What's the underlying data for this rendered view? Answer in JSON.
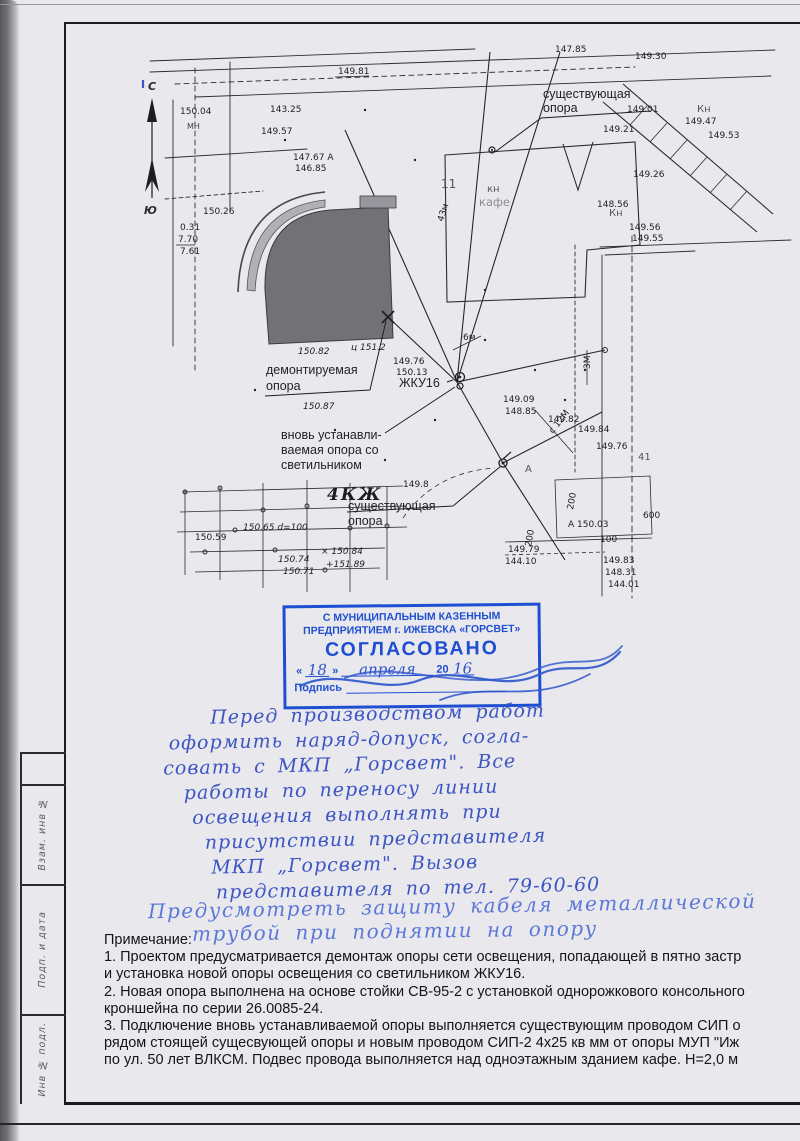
{
  "colors": {
    "stamp_blue": "#1e4fd2",
    "ink_blue": "#3b55c4",
    "ink_blue_light": "#5b77d9",
    "building_gray": "#717176"
  },
  "frame": {
    "side_cells": [
      "Взам. инв №",
      "Подп. и дата",
      "Инв № подл."
    ]
  },
  "map": {
    "compass": {
      "north": "С",
      "south": "Ю"
    },
    "labels": {
      "existing_top_line1": "существующая",
      "existing_top_line2": "опора",
      "dismantled_line1": "демонтируемая",
      "dismantled_line2": "опора",
      "zhku16": "ЖКУ16",
      "new_pole_line1": "вновь устанавли-",
      "new_pole_line2": "ваемая опора со",
      "new_pole_line3": "светильником",
      "block_4kzh": "4КЖ",
      "existing_bottom_line1": "существующая",
      "existing_bottom_line2": "опора",
      "kn_cafe": "кн",
      "cafe": "кафе",
      "kn_right": "Кн",
      "kn_top_right": "Кн",
      "house_number": "11"
    },
    "annotations": [
      "149.81",
      "147.85",
      "149.30",
      "143.25",
      "150.04",
      "МН",
      "149.57",
      "147.67 А",
      "146.85",
      "149.01",
      "149.21",
      "149.26",
      "148.56",
      "149.56",
      "149.55",
      "0.31",
      "7.70",
      "7.61",
      "150.26",
      "150.82",
      "ц 151.2",
      "150.87",
      "149.76",
      "150.13",
      "6м",
      "149.09",
      "148.85",
      "149.8",
      "А",
      "150.65 d=100",
      "150.59",
      "150.74",
      "150.71",
      "× 150.84",
      "+151.89",
      "149.82",
      "149.84",
      "149.76",
      "41",
      "А 150.03",
      "100",
      "149.79",
      "144.10",
      "149.83",
      "148.31",
      "144.01",
      "600",
      "149.47",
      "149.53",
      "200",
      "3М",
      "43м",
      "с 12М",
      "200"
    ]
  },
  "stamp": {
    "org_line1": "С МУНИЦИПАЛЬНЫМ КАЗЕННЫМ",
    "org_line2": "ПРЕДПРИЯТИЕМ  г. ИЖЕВСКА «ГОРСВЕТ»",
    "approved": "СОГЛАСОВАНО",
    "quote_open": "«",
    "quote_close": "»",
    "day": "18",
    "month": "апреля",
    "year_prefix": "20",
    "year": "16",
    "signature_label": "Подпись"
  },
  "handwriting": {
    "lines": [
      "Перед производством работ",
      "оформить наряд-допуск, согла-",
      "совать с МКП „Горсвет\".   Все",
      "работы по переносу линии",
      "освещения выполнять при",
      "присутствии представителя",
      "МКП „Горсвет\".   Вызов",
      "представителя по тел. 79-60-60",
      "Предусмотреть защиту кабеля металлической",
      "трубой при поднятии на опору"
    ]
  },
  "notes": {
    "title": "Примечание:",
    "lines": [
      "1. Проектом предусматривается демонтаж опоры сети освещения, попадающей в пятно застр",
      "и установка новой опоры освещения со светильником ЖКУ16.",
      "2. Новая опора выполнена на основе стойки СВ-95-2 с установкой однорожкового консольного",
      "кроншейна по серии 26.0085-24.",
      "3. Подключение вновь устанавливаемой опоры выполняется существующим проводом СИП о",
      "рядом стоящей сущесвующей опоры и новым проводом СИП-2 4х25 кв мм от опоры МУП \"Иж",
      "по ул. 50 лет ВЛКСМ. Подвес провода выполняется над одноэтажным зданием кафе. Н=2,0 м"
    ]
  }
}
